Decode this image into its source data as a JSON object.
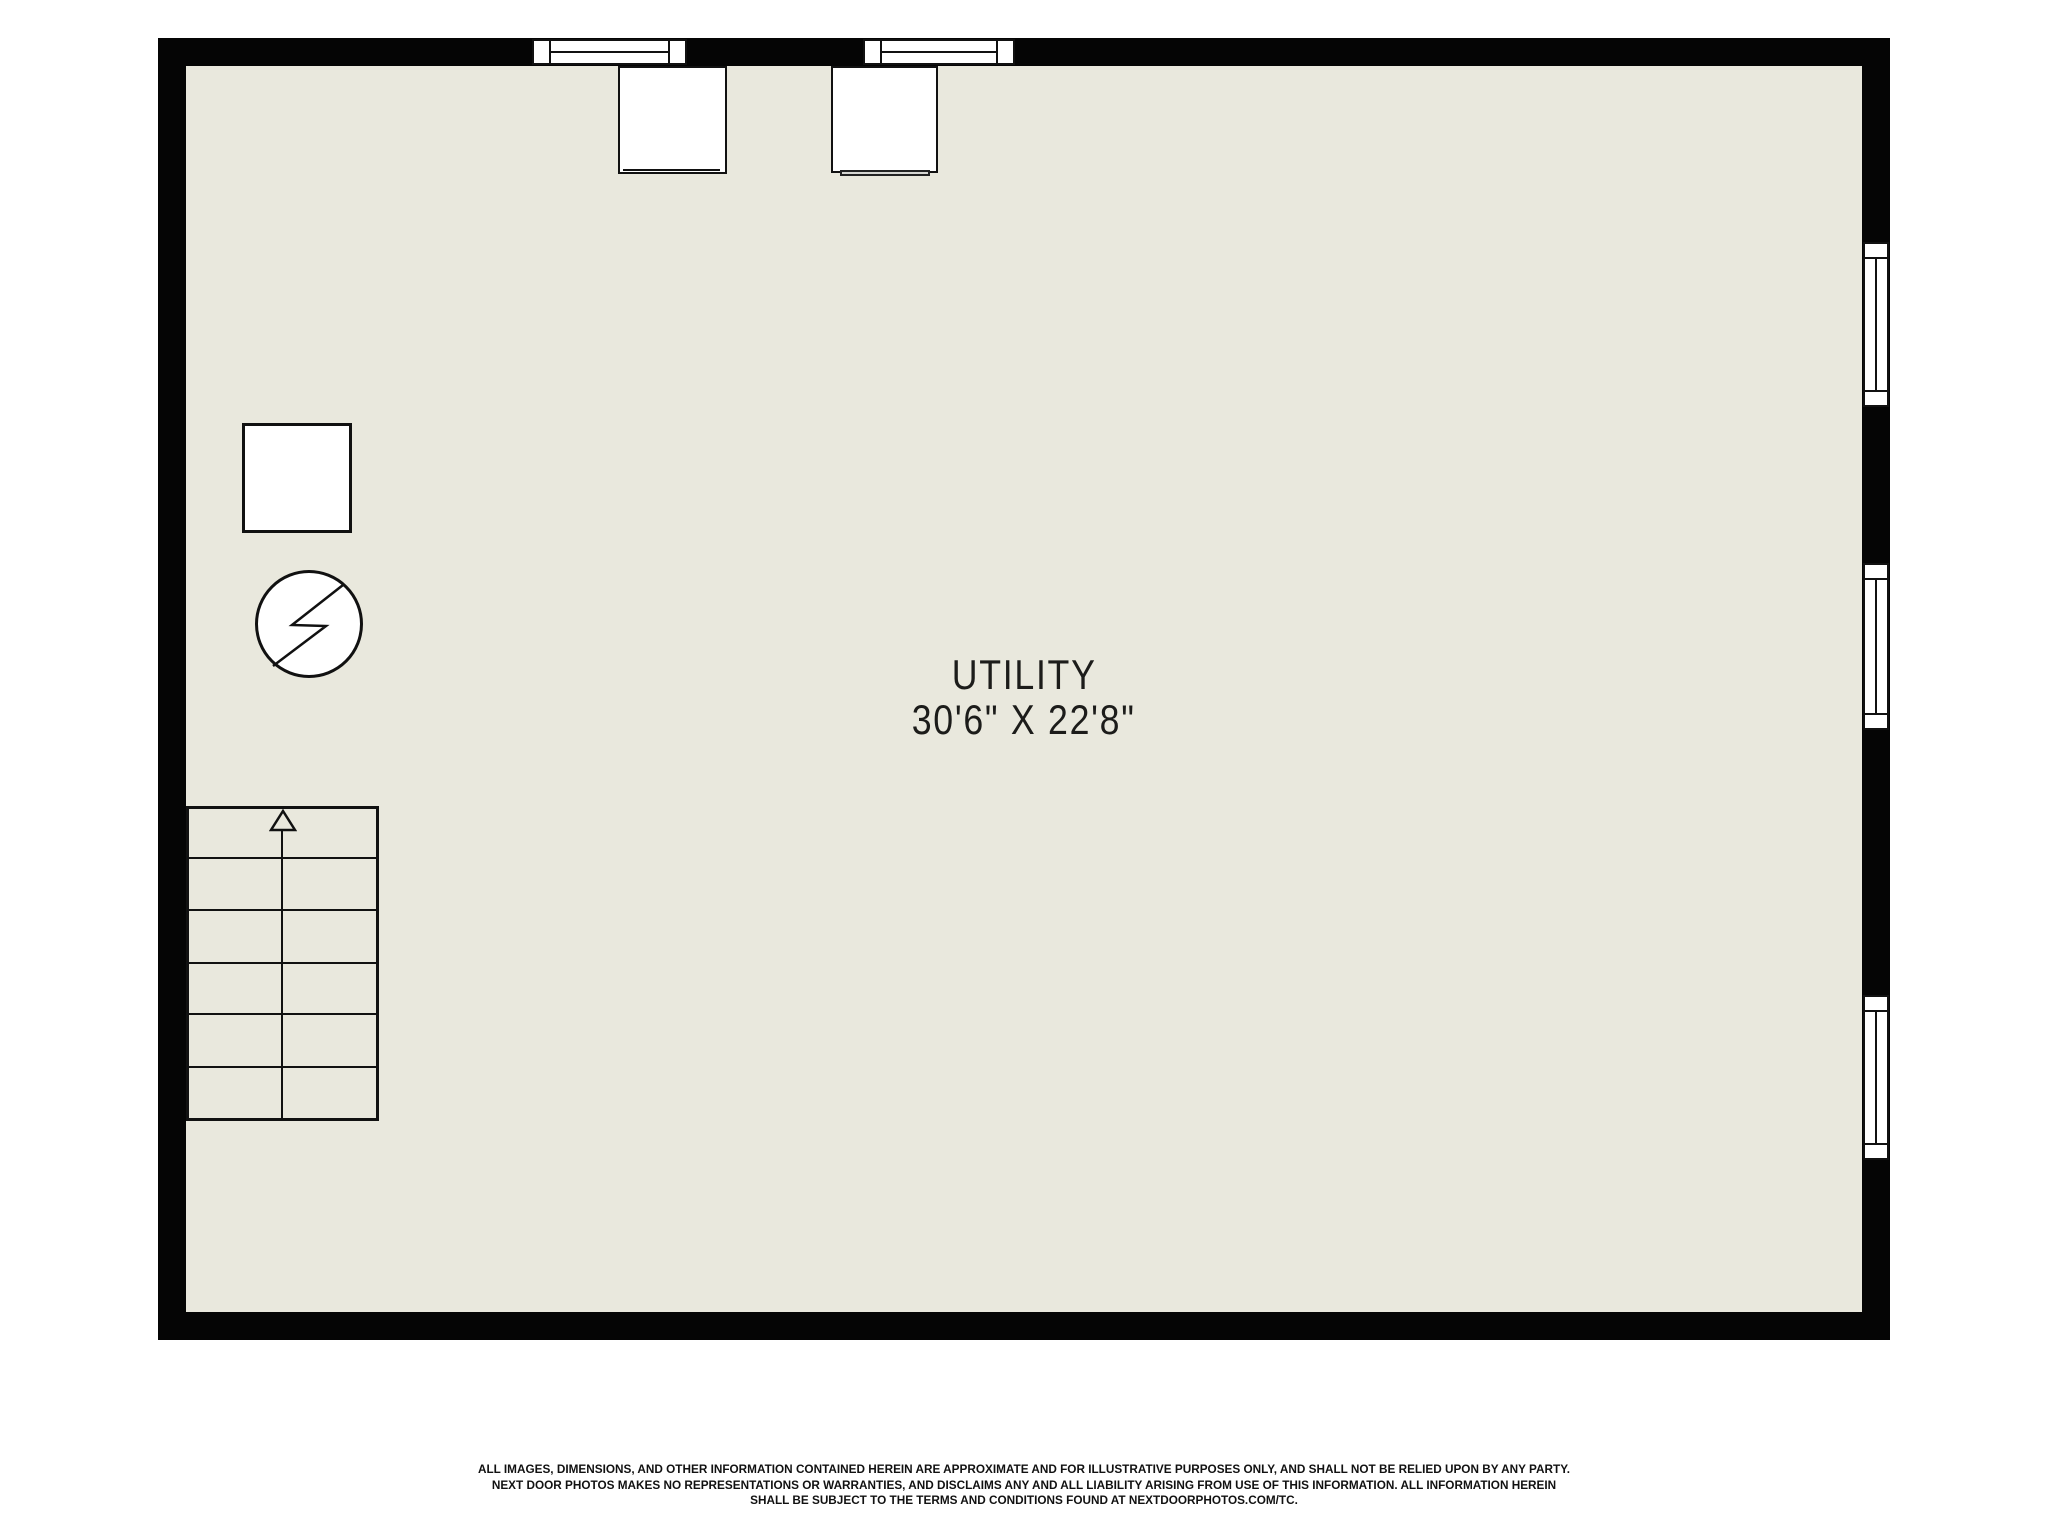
{
  "room_label": {
    "name": "UTILITY",
    "dimensions": "30'6\" X 22'8\""
  },
  "disclaimer": {
    "lines": [
      "ALL IMAGES, DIMENSIONS, AND OTHER INFORMATION CONTAINED HEREIN ARE APPROXIMATE AND FOR ILLUSTRATIVE PURPOSES ONLY, AND SHALL NOT BE RELIED UPON BY ANY PARTY.",
      "NEXT DOOR PHOTOS MAKES NO REPRESENTATIONS OR WARRANTIES, AND DISCLAIMS ANY AND ALL LIABILITY ARISING FROM USE OF THIS INFORMATION. ALL INFORMATION HEREIN",
      "SHALL BE SUBJECT TO THE TERMS AND CONDITIONS FOUND AT NEXTDOORPHOTOS.COM/TC."
    ]
  },
  "icons": {
    "lightning_bolt_icon": "zigzag-flash-in-circle",
    "up_arrow_icon": "triangle-up-stair-direction"
  },
  "colors": {
    "wall": "#050505",
    "floor": "#E9E8DD",
    "background": "#FFFFFF",
    "text": "#1C1C1A"
  }
}
